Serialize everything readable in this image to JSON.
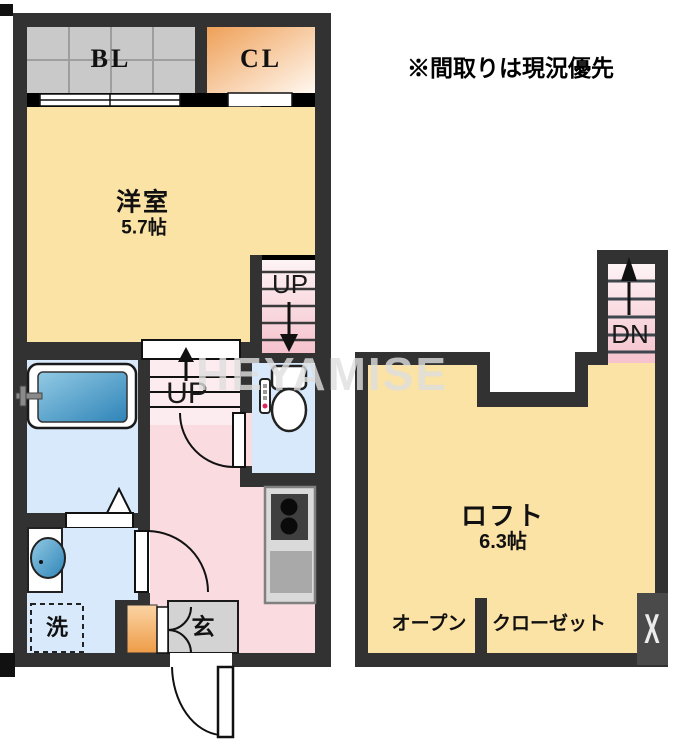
{
  "notice": {
    "text": "※間取りは現況優先"
  },
  "watermark": {
    "text": "HEYAMISE"
  },
  "floor_main": {
    "balcony_label": "BL",
    "closet_label": "CL",
    "room_name": "洋室",
    "room_size": "5.7帖",
    "stairs_upper_label": "UP",
    "stairs_lower_label": "UP",
    "entrance_label": "玄",
    "laundry_label": "洗"
  },
  "floor_loft": {
    "room_name": "ロフト",
    "room_size": "6.3帖",
    "stairs_label": "DN",
    "storage_open_label": "オープン",
    "storage_closet_label": "クローゼット",
    "window_mark": "X"
  },
  "colors": {
    "wall": "#323232",
    "window_band": "#000000",
    "room_cream": "#fbe2a5",
    "water_blue": "#d7e9fb",
    "hall_pink": "#f9dbe0",
    "stair_pink_light": "#fdf3f5",
    "stair_pink_deep": "#f5c2cd",
    "balcony_gray": "#c9c9c9",
    "entrance_gray": "#d3d3d3",
    "accent_orange": "#efa058",
    "tub_blue": "#2e84b8"
  }
}
